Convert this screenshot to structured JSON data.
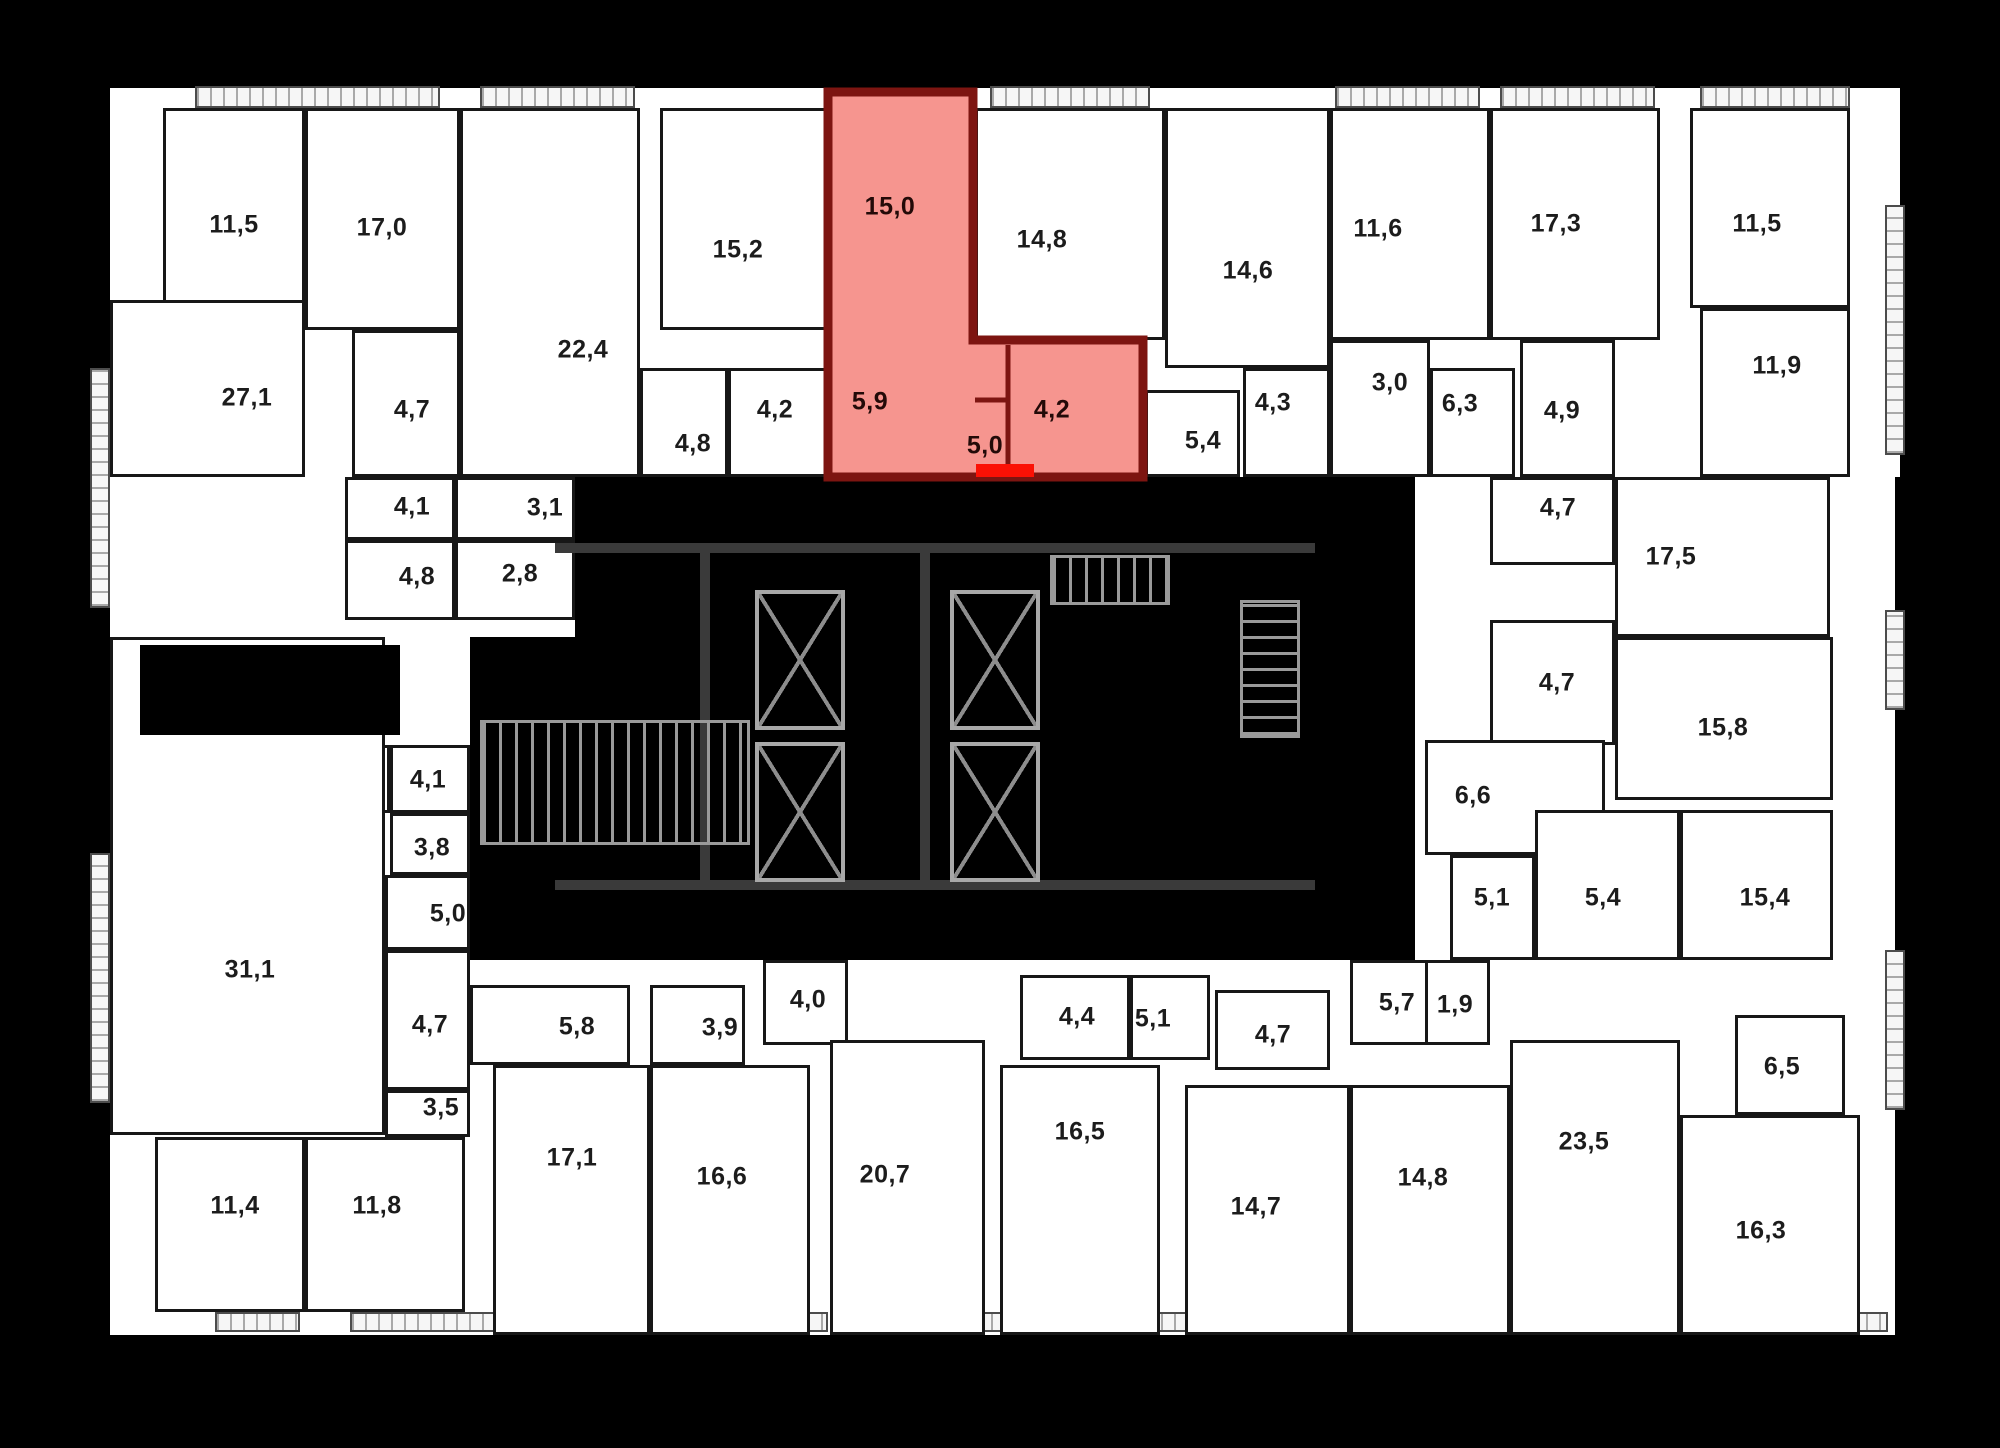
{
  "canvas": {
    "width": 2000,
    "height": 1448,
    "background": "#000000"
  },
  "palette": {
    "plan_fill": "#ffffff",
    "wall": "#171717",
    "highlight_fill": "#f4837b",
    "highlight_wall": "#7d1511",
    "entrance_marker": "#fb1105",
    "core_line": "#9a9a9a"
  },
  "plan": {
    "backing": [
      [
        110,
        88,
        1790,
        389
      ],
      [
        110,
        477,
        465,
        160
      ],
      [
        110,
        637,
        360,
        698
      ],
      [
        470,
        960,
        1425,
        375
      ],
      [
        1415,
        477,
        480,
        483
      ]
    ],
    "balconies": [
      {
        "rect": [
          195,
          86,
          245,
          22
        ],
        "dir": "h"
      },
      {
        "rect": [
          480,
          86,
          155,
          22
        ],
        "dir": "h"
      },
      {
        "rect": [
          990,
          86,
          160,
          22
        ],
        "dir": "h"
      },
      {
        "rect": [
          1335,
          86,
          145,
          22
        ],
        "dir": "h"
      },
      {
        "rect": [
          1500,
          86,
          155,
          22
        ],
        "dir": "h"
      },
      {
        "rect": [
          1700,
          86,
          150,
          22
        ],
        "dir": "h"
      },
      {
        "rect": [
          90,
          368,
          20,
          240
        ],
        "dir": "v"
      },
      {
        "rect": [
          90,
          853,
          20,
          250
        ],
        "dir": "v"
      },
      {
        "rect": [
          1885,
          205,
          20,
          250
        ],
        "dir": "v"
      },
      {
        "rect": [
          1885,
          610,
          20,
          100
        ],
        "dir": "v"
      },
      {
        "rect": [
          1885,
          950,
          20,
          160
        ],
        "dir": "v"
      },
      {
        "rect": [
          215,
          1312,
          85,
          20
        ],
        "dir": "h"
      },
      {
        "rect": [
          350,
          1312,
          230,
          20
        ],
        "dir": "h"
      },
      {
        "rect": [
          598,
          1312,
          230,
          20
        ],
        "dir": "h"
      },
      {
        "rect": [
          846,
          1312,
          230,
          20
        ],
        "dir": "h"
      },
      {
        "rect": [
          1094,
          1312,
          230,
          20
        ],
        "dir": "h"
      },
      {
        "rect": [
          1342,
          1312,
          230,
          20
        ],
        "dir": "h"
      },
      {
        "rect": [
          1590,
          1312,
          230,
          20
        ],
        "dir": "h"
      },
      {
        "rect": [
          1838,
          1312,
          50,
          20
        ],
        "dir": "h"
      }
    ],
    "notches": [
      [
        140,
        645,
        260,
        90
      ]
    ],
    "rooms": [
      {
        "label": "11,5",
        "rect": [
          163,
          108,
          142,
          222
        ],
        "lx": 234,
        "ly": 225
      },
      {
        "label": "17,0",
        "rect": [
          305,
          108,
          155,
          222
        ],
        "lx": 382,
        "ly": 228
      },
      {
        "label": "27,1",
        "rect": [
          110,
          300,
          195,
          177
        ],
        "lx": 247,
        "ly": 398
      },
      {
        "label": "4,7",
        "rect": [
          352,
          330,
          108,
          147
        ],
        "lx": 412,
        "ly": 410
      },
      {
        "label": "22,4",
        "rect": [
          460,
          108,
          180,
          369
        ],
        "lx": 583,
        "ly": 350
      },
      {
        "label": "15,2",
        "rect": [
          660,
          108,
          168,
          222
        ],
        "lx": 738,
        "ly": 250
      },
      {
        "label": "4,8",
        "rect": [
          640,
          368,
          88,
          109
        ],
        "lx": 693,
        "ly": 444
      },
      {
        "label": "4,2",
        "rect": [
          728,
          368,
          100,
          109
        ],
        "lx": 775,
        "ly": 410
      },
      {
        "label": "14,8",
        "rect": [
          975,
          108,
          190,
          232
        ],
        "lx": 1042,
        "ly": 240
      },
      {
        "label": "5,4",
        "rect": [
          1145,
          390,
          95,
          87
        ],
        "lx": 1203,
        "ly": 441
      },
      {
        "label": "14,6",
        "rect": [
          1165,
          108,
          165,
          260
        ],
        "lx": 1248,
        "ly": 271
      },
      {
        "label": "4,3",
        "rect": [
          1243,
          368,
          87,
          109
        ],
        "lx": 1273,
        "ly": 403
      },
      {
        "label": "3,0",
        "rect": [
          1330,
          340,
          100,
          137
        ],
        "lx": 1390,
        "ly": 383
      },
      {
        "label": "11,6",
        "rect": [
          1330,
          108,
          160,
          232
        ],
        "lx": 1378,
        "ly": 229
      },
      {
        "label": "6,3",
        "rect": [
          1430,
          368,
          85,
          109
        ],
        "lx": 1460,
        "ly": 404
      },
      {
        "label": "17,3",
        "rect": [
          1490,
          108,
          170,
          232
        ],
        "lx": 1556,
        "ly": 224
      },
      {
        "label": "4,9",
        "rect": [
          1520,
          340,
          95,
          137
        ],
        "lx": 1562,
        "ly": 411
      },
      {
        "label": "11,5",
        "rect": [
          1690,
          108,
          160,
          200
        ],
        "lx": 1757,
        "ly": 224
      },
      {
        "label": "11,9",
        "rect": [
          1700,
          308,
          150,
          169
        ],
        "lx": 1777,
        "ly": 366
      },
      {
        "label": "4,1",
        "rect": [
          345,
          477,
          110,
          63
        ],
        "lx": 412,
        "ly": 507
      },
      {
        "label": "3,1",
        "rect": [
          455,
          477,
          120,
          63
        ],
        "lx": 545,
        "ly": 508
      },
      {
        "label": "4,8",
        "rect": [
          345,
          540,
          110,
          80
        ],
        "lx": 417,
        "ly": 577
      },
      {
        "label": "2,8",
        "rect": [
          455,
          540,
          120,
          80
        ],
        "lx": 520,
        "ly": 574
      },
      {
        "label": "2,7",
        "rect": [
          305,
          745,
          85,
          68
        ],
        "lx": 345,
        "ly": 781
      },
      {
        "label": "4,1",
        "rect": [
          390,
          745,
          80,
          68
        ],
        "lx": 428,
        "ly": 780
      },
      {
        "label": "3,8",
        "rect": [
          390,
          813,
          80,
          62
        ],
        "lx": 432,
        "ly": 848
      },
      {
        "label": "5,0",
        "rect": [
          385,
          875,
          85,
          75
        ],
        "lx": 448,
        "ly": 914
      },
      {
        "label": "31,1",
        "rect": [
          110,
          637,
          275,
          498
        ],
        "lx": 250,
        "ly": 970
      },
      {
        "label": "4,7",
        "rect": [
          385,
          950,
          85,
          140
        ],
        "lx": 430,
        "ly": 1025
      },
      {
        "label": "3,5",
        "rect": [
          385,
          1090,
          85,
          47
        ],
        "lx": 441,
        "ly": 1108
      },
      {
        "label": "11,4",
        "rect": [
          155,
          1137,
          150,
          175
        ],
        "lx": 235,
        "ly": 1206
      },
      {
        "label": "11,8",
        "rect": [
          305,
          1137,
          160,
          175
        ],
        "lx": 377,
        "ly": 1206
      },
      {
        "label": "4,7",
        "rect": [
          1490,
          477,
          125,
          88
        ],
        "lx": 1558,
        "ly": 508
      },
      {
        "label": "17,5",
        "rect": [
          1615,
          477,
          215,
          160
        ],
        "lx": 1671,
        "ly": 557
      },
      {
        "label": "4,7",
        "rect": [
          1490,
          620,
          125,
          125
        ],
        "lx": 1557,
        "ly": 683
      },
      {
        "label": "15,8",
        "rect": [
          1615,
          637,
          218,
          163
        ],
        "lx": 1723,
        "ly": 728
      },
      {
        "label": "6,6",
        "rect": [
          1425,
          740,
          180,
          115
        ],
        "lx": 1473,
        "ly": 796
      },
      {
        "label": "5,1",
        "rect": [
          1450,
          855,
          85,
          105
        ],
        "lx": 1492,
        "ly": 898
      },
      {
        "label": "5,4",
        "rect": [
          1535,
          810,
          145,
          150
        ],
        "lx": 1603,
        "ly": 898
      },
      {
        "label": "15,4",
        "rect": [
          1680,
          810,
          153,
          150
        ],
        "lx": 1765,
        "ly": 898
      },
      {
        "label": "5,8",
        "rect": [
          470,
          985,
          160,
          80
        ],
        "lx": 577,
        "ly": 1027
      },
      {
        "label": "3,9",
        "rect": [
          650,
          985,
          95,
          80
        ],
        "lx": 720,
        "ly": 1028
      },
      {
        "label": "4,0",
        "rect": [
          763,
          960,
          85,
          85
        ],
        "lx": 808,
        "ly": 1000
      },
      {
        "label": "17,1",
        "rect": [
          493,
          1065,
          157,
          270
        ],
        "lx": 572,
        "ly": 1158
      },
      {
        "label": "16,6",
        "rect": [
          650,
          1065,
          160,
          270
        ],
        "lx": 722,
        "ly": 1177
      },
      {
        "label": "20,7",
        "rect": [
          830,
          1040,
          155,
          295
        ],
        "lx": 885,
        "ly": 1175
      },
      {
        "label": "4,4",
        "rect": [
          1020,
          975,
          110,
          85
        ],
        "lx": 1077,
        "ly": 1017
      },
      {
        "label": "5,1",
        "rect": [
          1130,
          975,
          80,
          85
        ],
        "lx": 1153,
        "ly": 1019
      },
      {
        "label": "16,5",
        "rect": [
          1000,
          1065,
          160,
          270
        ],
        "lx": 1080,
        "ly": 1132
      },
      {
        "label": "4,7",
        "rect": [
          1215,
          990,
          115,
          80
        ],
        "lx": 1273,
        "ly": 1035
      },
      {
        "label": "14,7",
        "rect": [
          1185,
          1085,
          165,
          250
        ],
        "lx": 1256,
        "ly": 1207
      },
      {
        "label": "5,7",
        "rect": [
          1350,
          960,
          110,
          85
        ],
        "lx": 1397,
        "ly": 1003
      },
      {
        "label": "1,9",
        "rect": [
          1425,
          960,
          65,
          85
        ],
        "lx": 1455,
        "ly": 1005
      },
      {
        "label": "14,8",
        "rect": [
          1350,
          1085,
          160,
          250
        ],
        "lx": 1423,
        "ly": 1178
      },
      {
        "label": "23,5",
        "rect": [
          1510,
          1040,
          170,
          295
        ],
        "lx": 1584,
        "ly": 1142
      },
      {
        "label": "6,5",
        "rect": [
          1735,
          1015,
          110,
          100
        ],
        "lx": 1782,
        "ly": 1067
      },
      {
        "label": "16,3",
        "rect": [
          1680,
          1115,
          180,
          220
        ],
        "lx": 1761,
        "ly": 1231
      }
    ],
    "core": {
      "walls": [
        [
          555,
          543,
          760,
          10
        ],
        [
          700,
          553,
          10,
          330
        ],
        [
          920,
          553,
          10,
          330
        ],
        [
          555,
          880,
          760,
          10
        ]
      ],
      "elevators": [
        [
          755,
          590,
          90,
          140
        ],
        [
          950,
          590,
          90,
          140
        ],
        [
          755,
          742,
          90,
          140
        ],
        [
          950,
          742,
          90,
          140
        ]
      ],
      "stairs": [
        {
          "rect": [
            480,
            720,
            270,
            125
          ],
          "dir": "h"
        },
        {
          "rect": [
            1240,
            600,
            60,
            138
          ],
          "dir": "v"
        },
        {
          "rect": [
            1050,
            555,
            120,
            50
          ],
          "dir": "h"
        }
      ]
    },
    "highlight": {
      "polygon": [
        [
          828,
          92
        ],
        [
          973,
          92
        ],
        [
          973,
          340
        ],
        [
          1143,
          340
        ],
        [
          1143,
          477
        ],
        [
          828,
          477
        ]
      ],
      "inner_walls": [
        [
          1008,
          345,
          1008,
          470
        ],
        [
          975,
          400,
          1008,
          400
        ]
      ],
      "entrance": [
        976,
        464,
        58,
        13
      ],
      "rooms": [
        {
          "label": "15,0",
          "lx": 890,
          "ly": 207
        },
        {
          "label": "5,9",
          "lx": 870,
          "ly": 402
        },
        {
          "label": "5,0",
          "lx": 985,
          "ly": 446
        },
        {
          "label": "4,2",
          "lx": 1052,
          "ly": 410
        }
      ]
    }
  }
}
